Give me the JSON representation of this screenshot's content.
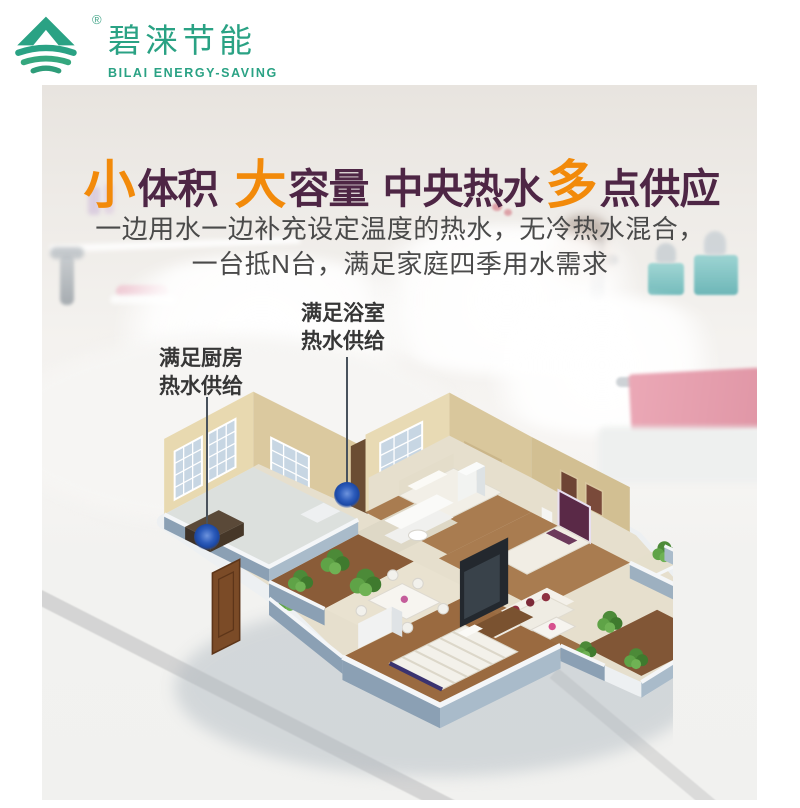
{
  "brand": {
    "logo_zh": "碧涞节能",
    "logo_en": "BILAI ENERGY-SAVING",
    "registered_mark": "®",
    "logo_icon": "mountain-wave-icon"
  },
  "headline": {
    "parts": [
      {
        "text": "小",
        "accent": true
      },
      {
        "text": "体积",
        "accent": false
      },
      {
        "text": "大",
        "accent": true
      },
      {
        "text": "容量",
        "accent": false
      },
      {
        "text": "中央热水",
        "accent": false
      },
      {
        "text": "多",
        "accent": true
      },
      {
        "text": "点供应",
        "accent": false
      }
    ]
  },
  "subtitle": {
    "line1": "一边用水一边补充设定温度的热水，无冷热水混合，",
    "line2": "一台抵N台，满足家庭四季用水需求"
  },
  "callouts": {
    "kitchen": {
      "line1": "满足厨房",
      "line2": "热水供给"
    },
    "bathroom": {
      "line1": "满足浴室",
      "line2": "热水供给"
    }
  },
  "colors": {
    "brand_green": "#2aa284",
    "accent_orange": "#f28a0a",
    "headline_plum": "#4e2645",
    "subtitle_gray": "#4a4a4a",
    "hot_water_marker_blue": "#1b48a5"
  }
}
